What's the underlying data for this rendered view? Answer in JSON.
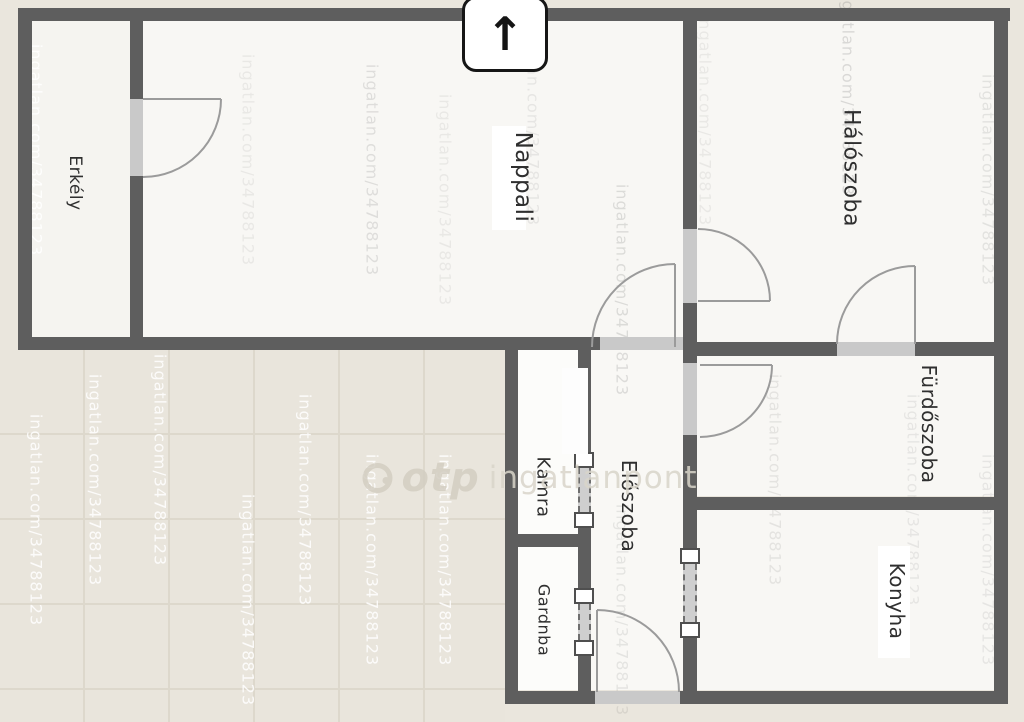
{
  "floorplan": {
    "compass": {
      "symbol": "↑"
    },
    "rooms": [
      {
        "id": "erkely",
        "label": "Erkély"
      },
      {
        "id": "nappali",
        "label": "Nappali"
      },
      {
        "id": "haloszoba",
        "label": "Hálószoba"
      },
      {
        "id": "furdoszoba",
        "label": "Fürdőszoba"
      },
      {
        "id": "kamra",
        "label": "Kamra"
      },
      {
        "id": "eloszoba",
        "label": "Előszoba"
      },
      {
        "id": "gardnba",
        "label": "Gardnba"
      },
      {
        "id": "konyha",
        "label": "Konyha"
      }
    ],
    "watermark": {
      "repeated_text": "ingatlan.com/34788123",
      "brand_bold": "otp",
      "brand_light": "ingatlanpont"
    },
    "colors": {
      "wall": "#5e5e5e",
      "floor": "#f8f7f4",
      "outside": "#eae6dd",
      "door_opening": "#c9c9c9",
      "door_arc": "#9b9b9b"
    }
  }
}
